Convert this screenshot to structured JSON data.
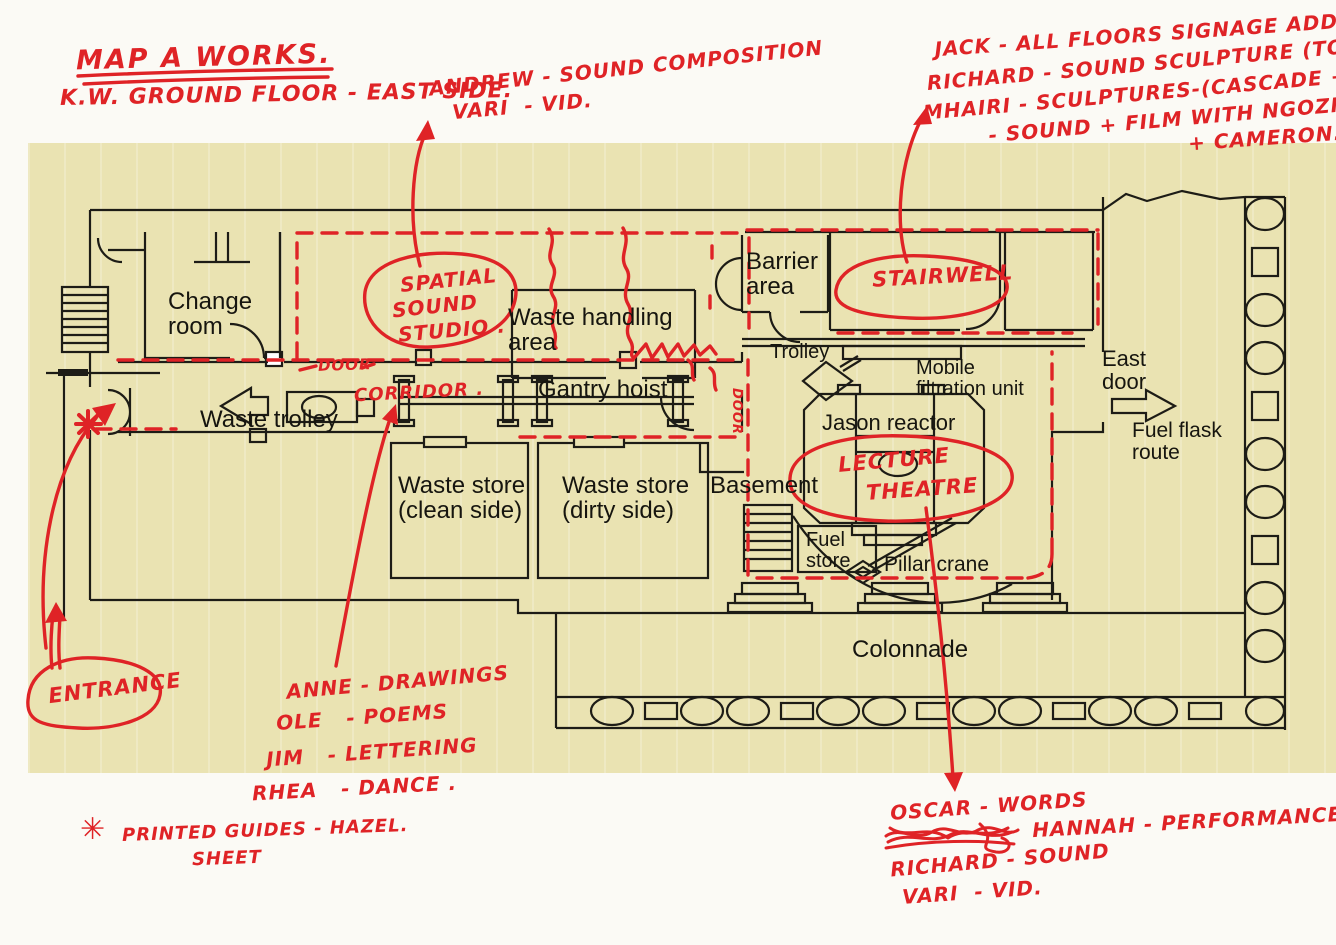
{
  "colors": {
    "paper": "#fbfaf5",
    "map_cream": "#eae3b2",
    "ink": "#16150f",
    "red": "#df2326"
  },
  "header": {
    "title": "MAP A WORKS.",
    "subtitle": "K.W. GROUND FLOOR - EAST SIDE."
  },
  "notes": {
    "asterisk": "✳",
    "top_center": [
      "ANDREW - SOUND COMPOSITION",
      "VARI  - VID."
    ],
    "top_right": [
      "JACK - ALL FLOORS SIGNAGE ADDITIONS.",
      "RICHARD - SOUND SCULPTURE (TOP SHELF)",
      "MHAIRI - SCULPTURES-(CASCADE + SHELF)",
      "- SOUND + FILM WITH NGOZI",
      "+ CAMERON."
    ],
    "bottom_left": [
      "ANNE - DRAWINGS",
      "OLE   - POEMS",
      "JIM   - LETTERING",
      "RHEA   - DANCE ."
    ],
    "bottom_right": [
      "OSCAR - WORDS",
      "HANNAH - PERFORMANCE",
      "RICHARD - SOUND",
      "VARI  - VID."
    ],
    "printed_guides": [
      "PRINTED GUIDES - HAZEL.",
      "SHEET"
    ]
  },
  "rooms": {
    "change_room": "Change\nroom",
    "waste_handling": "Waste handling\narea",
    "barrier_area": "Barrier\narea",
    "trolley": "Trolley",
    "mobile_filtration": "Mobile\nfiltration unit",
    "east_door": "East\ndoor",
    "fuel_flask_route": "Fuel flask\nroute",
    "gantry_hoist": "Gantry hoist",
    "waste_trolley": "Waste trolley",
    "jason_reactor": "Jason reactor",
    "waste_store_clean": "Waste store\n(clean side)",
    "waste_store_dirty": "Waste store\n(dirty side)",
    "basement": "Basement",
    "fuel_store": "Fuel\nstore",
    "pillar_crane": "Pillar crane",
    "colonnade": "Colonnade"
  },
  "red_labels": {
    "spatial": [
      "SPATIAL",
      "SOUND",
      "STUDIO ."
    ],
    "door": "DOOR",
    "corridor": "CORRIDOR .",
    "door_vertical": "DOOR",
    "stairwell": "STAIRWELL",
    "lecture": [
      "LECTURE",
      "THEATRE"
    ],
    "entrance": "ENTRANCE"
  }
}
